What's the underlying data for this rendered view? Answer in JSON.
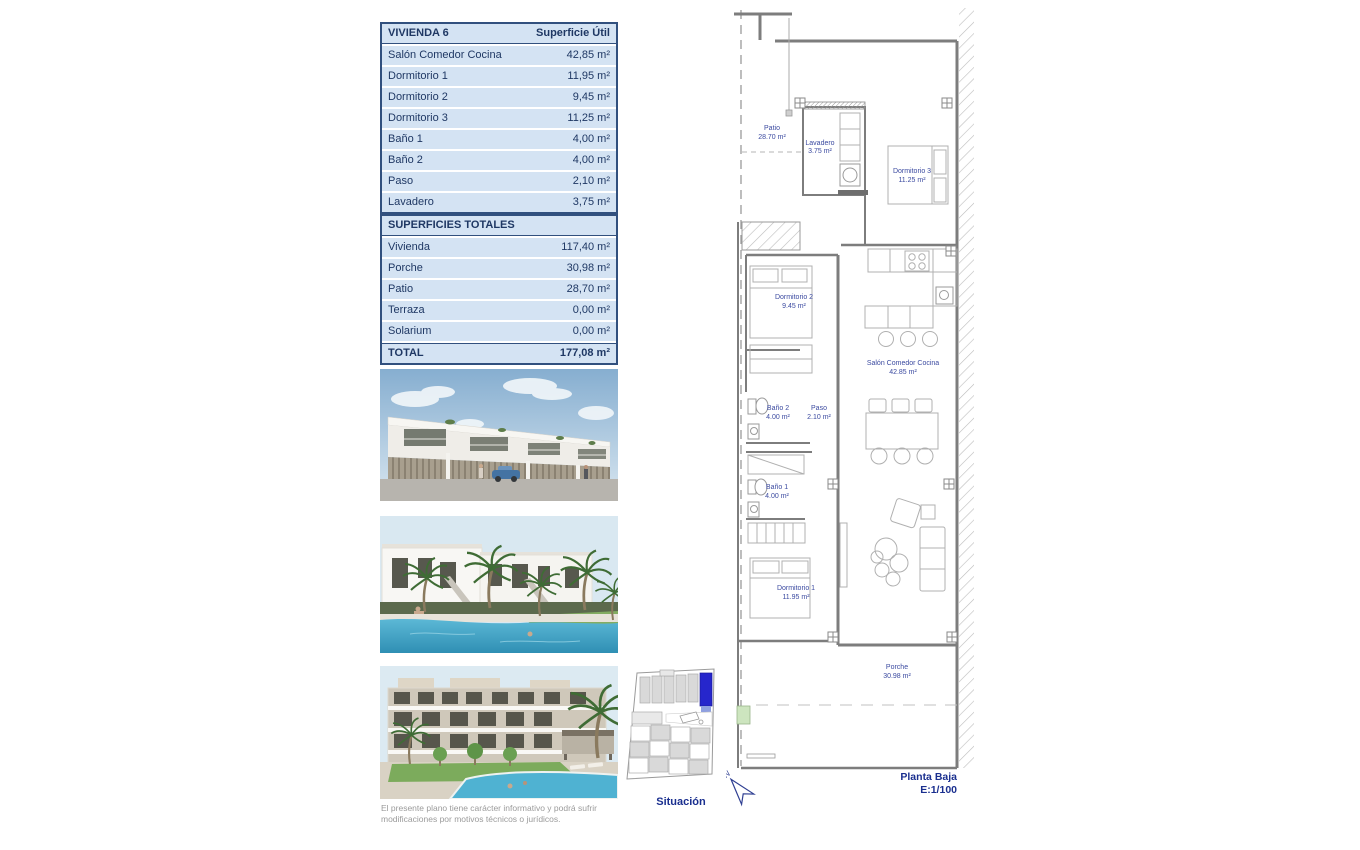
{
  "vivienda_table": {
    "title": "VIVIENDA 6",
    "col_header": "Superficie Útil",
    "rows": [
      {
        "label": "Salón Comedor Cocina",
        "value": "42,85 m²"
      },
      {
        "label": "Dormitorio 1",
        "value": "11,95 m²"
      },
      {
        "label": "Dormitorio 2",
        "value": "9,45 m²"
      },
      {
        "label": "Dormitorio 3",
        "value": "11,25 m²"
      },
      {
        "label": "Baño 1",
        "value": "4,00 m²"
      },
      {
        "label": "Baño 2",
        "value": "4,00 m²"
      },
      {
        "label": "Paso",
        "value": "2,10 m²"
      },
      {
        "label": "Lavadero",
        "value": "3,75 m²"
      }
    ]
  },
  "totales_table": {
    "title": "SUPERFICIES TOTALES",
    "rows": [
      {
        "label": "Vivienda",
        "value": "117,40 m²"
      },
      {
        "label": "Porche",
        "value": "30,98 m²"
      },
      {
        "label": "Patio",
        "value": "28,70 m²"
      },
      {
        "label": "Terraza",
        "value": "0,00 m²"
      },
      {
        "label": "Solarium",
        "value": "0,00 m²"
      }
    ],
    "total_label": "TOTAL",
    "total_value": "177,08 m²"
  },
  "plan": {
    "rooms": {
      "patio": {
        "name": "Patio",
        "area": "28.70 m²"
      },
      "lavadero": {
        "name": "Lavadero",
        "area": "3.75 m²"
      },
      "dormitorio3": {
        "name": "Dormitorio 3",
        "area": "11.25 m²"
      },
      "dormitorio2": {
        "name": "Dormitorio 2",
        "area": "9.45 m²"
      },
      "salon": {
        "name": "Salón Comedor Cocina",
        "area": "42.85 m²"
      },
      "bano2": {
        "name": "Baño 2",
        "area": "4.00 m²"
      },
      "paso": {
        "name": "Paso",
        "area": "2.10 m²"
      },
      "bano1": {
        "name": "Baño 1",
        "area": "4.00 m²"
      },
      "dormitorio1": {
        "name": "Dormitorio 1",
        "area": "11.95 m²"
      },
      "porche": {
        "name": "Porche",
        "area": "30.98 m²"
      }
    },
    "caption": {
      "line1": "Planta Baja",
      "line2": "E:1/100"
    },
    "north": "N"
  },
  "situacion": {
    "label": "Situación"
  },
  "disclaimer": {
    "line1": "El presente plano tiene carácter informativo y podrá sufrir",
    "line2": "modificaciones por motivos técnicos o jurídicos."
  },
  "colors": {
    "table_cell_bg": "#d4e3f3",
    "table_text": "#1f3864",
    "table_border": "#31507e",
    "plan_label": "#3b4aa0",
    "plan_caption": "#1a2f8f",
    "situacion_highlight": "#2626cc",
    "boundary_green": "#cde5bf"
  }
}
